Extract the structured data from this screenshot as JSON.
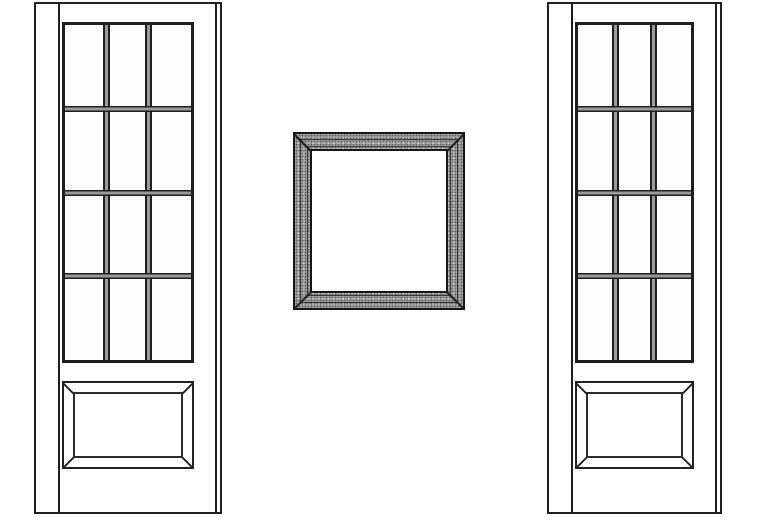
{
  "scene": {
    "type": "technical-illustration",
    "background": "#ffffff",
    "description": "Two twelve-lite French door elevations flanking a square mitered picture frame"
  },
  "left_door": {
    "x": 34,
    "y": 2,
    "width": 188,
    "height": 512
  },
  "right_door": {
    "x": 547,
    "y": 2,
    "width": 175,
    "height": 512
  },
  "door_style": {
    "grid_columns": 3,
    "grid_rows": 4,
    "lite_count": 12,
    "line_color": "#1f1f1f",
    "muntin_core_color": "#9a9a9a",
    "glass_top_offset": 18,
    "glass_height": 341,
    "glass_side_inset": 26,
    "edge_line_left_offset": 22,
    "edge_line_right_offset": 3,
    "panel_top": 377,
    "panel_height": 88
  },
  "picture_frame": {
    "x": 293,
    "y": 132,
    "width": 172,
    "height": 178,
    "border_color": "#161616",
    "molding_fill": "#a3a3a3",
    "opening_fill": "#ffffff"
  }
}
